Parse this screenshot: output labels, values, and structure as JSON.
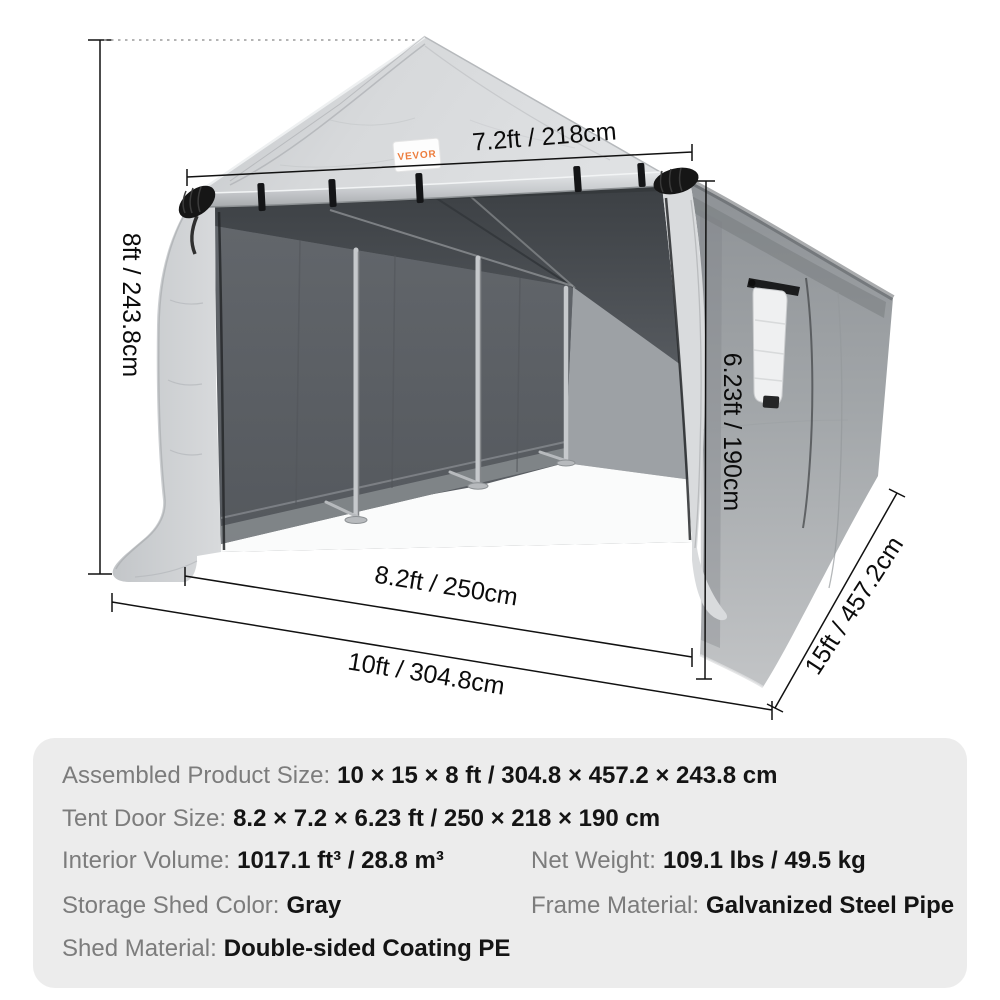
{
  "brand": {
    "logo": "VEVOR"
  },
  "dimensions": {
    "top_door_width": "7.2ft / 218cm",
    "overall_height": "8ft / 243.8cm",
    "door_height": "6.23ft / 190cm",
    "door_width": "8.2ft / 250cm",
    "overall_width": "10ft / 304.8cm",
    "overall_depth": "15ft / 457.2cm"
  },
  "specs": {
    "assembled_size": {
      "label": "Assembled Product Size:",
      "value": "10 × 15 × 8 ft / 304.8 × 457.2 × 243.8 cm"
    },
    "tent_door_size": {
      "label": "Tent Door Size:",
      "value": "8.2 × 7.2 × 6.23 ft / 250 × 218 × 190 cm"
    },
    "interior_volume": {
      "label": "Interior Volume:",
      "value": "1017.1 ft³ / 28.8 m³"
    },
    "net_weight": {
      "label": "Net Weight:",
      "value": "109.1 lbs / 49.5 kg"
    },
    "shed_color": {
      "label": "Storage Shed Color:",
      "value": "Gray"
    },
    "frame_material": {
      "label": "Frame Material:",
      "value": "Galvanized Steel Pipe"
    },
    "shed_material": {
      "label": "Shed Material:",
      "value": "Double-sided Coating PE"
    }
  },
  "colors": {
    "brand_orange": "#ed7d3d",
    "panel_background": "#ececec",
    "label_gray": "#7c7c7c",
    "value_black": "#141414",
    "tarp_silver": "#d3d5d7"
  }
}
